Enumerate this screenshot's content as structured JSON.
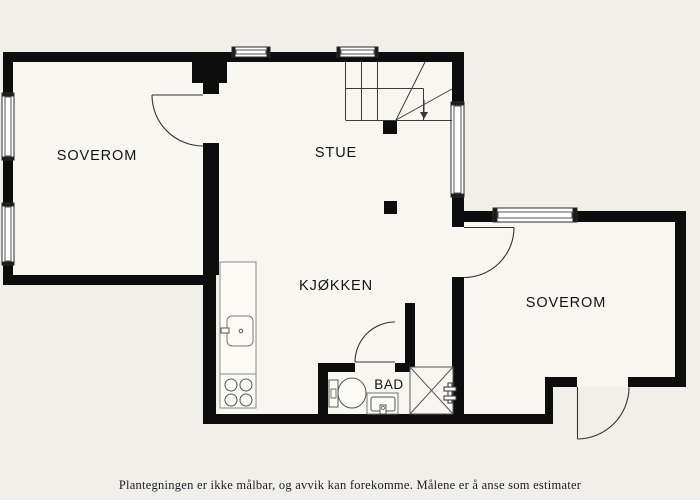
{
  "colors": {
    "background": "#f1efe9",
    "floor": "#f8f6f1",
    "wall": "#0d0d0d",
    "line": "#3a3a3a",
    "fixture_fill": "#fbfaf5"
  },
  "rooms": {
    "bedroom_left": {
      "label": "SOVEROM"
    },
    "living_room": {
      "label": "STUE"
    },
    "kitchen": {
      "label": "KJØKKEN"
    },
    "bathroom": {
      "label": "BAD"
    },
    "bedroom_right": {
      "label": "SOVEROM"
    }
  },
  "caption": "Plantegningen er ikke målbar, og avvik kan forekomme. Målene er å anse som estimater"
}
